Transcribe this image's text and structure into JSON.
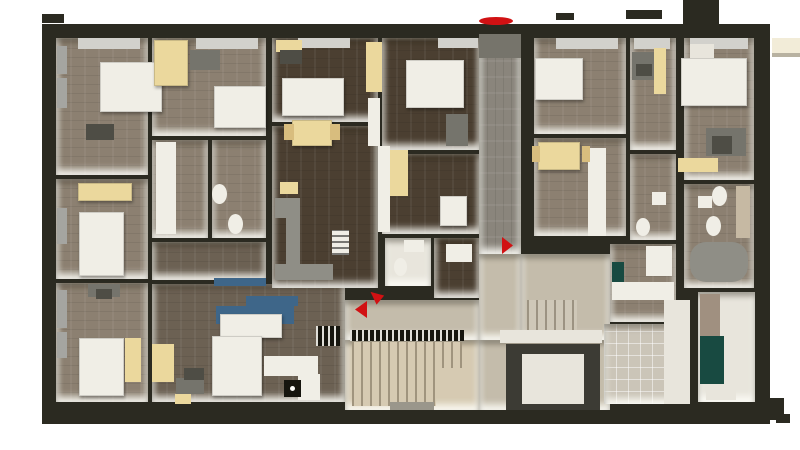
{
  "palette": {
    "wall": "#2b2a21",
    "A": "#8c8071",
    "B": "#4b3f31",
    "LV": "#6c6153",
    "C": "#8a857c",
    "D": "#c4bcab",
    "ST": "#d6cab2",
    "STL": "#cfc8b8",
    "TILE": "#cbc5b8",
    "WHT": "#e8e5dc",
    "GRY": "#76746b",
    "GRY2": "#9a968b",
    "white": "#f0eee6",
    "bright": "#fbfbf8",
    "glass": "#a5a5a1",
    "glassL": "#d2d1cc",
    "yellow": "#ebd89d",
    "yellowD": "#d8bd7e",
    "gray": "#75746c",
    "grayD": "#4e4d45",
    "blue": "#3e6689",
    "teal": "#184a41",
    "black": "#16150e",
    "red": "#d11113",
    "cream": "#f2ecd8",
    "shadow": "#b8b2a1",
    "metal": "#8f8e86",
    "elev": "#3c3b34",
    "woodS": "#a09080",
    "tileD": "#c6b9a3"
  },
  "scene": [
    {
      "n": "building-outline",
      "x": 42,
      "y": 24,
      "w": 728,
      "h": 400,
      "c": "wall"
    },
    {
      "n": "top-wall-stub-a",
      "x": 42,
      "y": 14,
      "w": 22,
      "h": 9,
      "c": "wall"
    },
    {
      "n": "top-wall-stub-b",
      "x": 556,
      "y": 13,
      "w": 18,
      "h": 7,
      "c": "wall"
    },
    {
      "n": "top-wall-stub-c",
      "x": 626,
      "y": 10,
      "w": 36,
      "h": 9,
      "c": "wall"
    },
    {
      "n": "top-wall-block",
      "x": 683,
      "y": 0,
      "w": 36,
      "h": 26,
      "c": "wall"
    },
    {
      "n": "canopy",
      "x": 772,
      "y": 38,
      "w": 28,
      "h": 15,
      "c": "cream"
    },
    {
      "n": "canopy-shadow",
      "x": 772,
      "y": 53,
      "w": 28,
      "h": 4,
      "c": "shadow"
    },
    {
      "n": "bottom-wall-step",
      "x": 756,
      "y": 398,
      "w": 28,
      "h": 22,
      "c": "wall"
    },
    {
      "n": "bottom-wall-foot",
      "x": 776,
      "y": 414,
      "w": 14,
      "h": 9,
      "c": "wall"
    },
    {
      "n": "room-bed-1",
      "x": 56,
      "y": 38,
      "w": 92,
      "h": 137,
      "c": "A",
      "cls": "room planks"
    },
    {
      "n": "room-bed-2",
      "x": 56,
      "y": 179,
      "w": 92,
      "h": 100,
      "c": "A",
      "cls": "room planks"
    },
    {
      "n": "room-bed-3",
      "x": 56,
      "y": 283,
      "w": 92,
      "h": 119,
      "c": "A",
      "cls": "room planks"
    },
    {
      "n": "room-bed-4",
      "x": 152,
      "y": 38,
      "w": 114,
      "h": 98,
      "c": "A",
      "cls": "room planks"
    },
    {
      "n": "room-bath-1",
      "x": 152,
      "y": 140,
      "w": 56,
      "h": 98,
      "c": "A",
      "cls": "room planks"
    },
    {
      "n": "room-bath-2",
      "x": 212,
      "y": 140,
      "w": 54,
      "h": 98,
      "c": "A",
      "cls": "room planks"
    },
    {
      "n": "room-living-strip",
      "x": 152,
      "y": 242,
      "w": 114,
      "h": 38,
      "c": "LV",
      "cls": "room planks"
    },
    {
      "n": "room-living",
      "x": 152,
      "y": 284,
      "w": 193,
      "h": 118,
      "c": "LV",
      "cls": "room planks"
    },
    {
      "n": "room-dark-1",
      "x": 272,
      "y": 38,
      "w": 106,
      "h": 84,
      "c": "B",
      "cls": "room planks"
    },
    {
      "n": "room-dark-2",
      "x": 382,
      "y": 38,
      "w": 98,
      "h": 112,
      "c": "B",
      "cls": "room planks"
    },
    {
      "n": "room-dark-3",
      "x": 272,
      "y": 126,
      "w": 106,
      "h": 162,
      "c": "B",
      "cls": "room planks"
    },
    {
      "n": "room-dark-4",
      "x": 382,
      "y": 154,
      "w": 98,
      "h": 80,
      "c": "B",
      "cls": "room planks"
    },
    {
      "n": "room-bath-mid",
      "x": 385,
      "y": 238,
      "w": 46,
      "h": 48,
      "c": "WHT",
      "cls": "room"
    },
    {
      "n": "room-dark-5",
      "x": 434,
      "y": 238,
      "w": 46,
      "h": 60,
      "c": "B",
      "cls": "room planks"
    },
    {
      "n": "corridor",
      "x": 479,
      "y": 34,
      "w": 42,
      "h": 220,
      "c": "C",
      "cls": "room planksv"
    },
    {
      "n": "entry-pad",
      "x": 479,
      "y": 34,
      "w": 42,
      "h": 24,
      "c": "GRY"
    },
    {
      "n": "hall-mid",
      "x": 479,
      "y": 254,
      "w": 42,
      "h": 86,
      "c": "D",
      "cls": "room"
    },
    {
      "n": "hall-left",
      "x": 345,
      "y": 300,
      "w": 134,
      "h": 40,
      "c": "D",
      "cls": "room"
    },
    {
      "n": "hall-right",
      "x": 521,
      "y": 254,
      "w": 89,
      "h": 86,
      "c": "D",
      "cls": "room"
    },
    {
      "n": "stair-room",
      "x": 345,
      "y": 340,
      "w": 134,
      "h": 70,
      "c": "ST",
      "cls": "room"
    },
    {
      "n": "elevator-hall",
      "x": 479,
      "y": 340,
      "w": 131,
      "h": 70,
      "c": "D",
      "cls": "room"
    },
    {
      "n": "room-bed-5",
      "x": 534,
      "y": 38,
      "w": 92,
      "h": 96,
      "c": "A",
      "cls": "room planks"
    },
    {
      "n": "room-desk",
      "x": 630,
      "y": 38,
      "w": 46,
      "h": 112,
      "c": "A",
      "cls": "room planks"
    },
    {
      "n": "room-living-2",
      "x": 534,
      "y": 138,
      "w": 92,
      "h": 98,
      "c": "A",
      "cls": "room planks"
    },
    {
      "n": "room-bath-3",
      "x": 630,
      "y": 154,
      "w": 46,
      "h": 86,
      "c": "A",
      "cls": "room planks"
    },
    {
      "n": "room-kitchen-2",
      "x": 610,
      "y": 244,
      "w": 66,
      "h": 78,
      "c": "A",
      "cls": "room planks"
    },
    {
      "n": "room-tile",
      "x": 604,
      "y": 324,
      "w": 86,
      "h": 80,
      "c": "TILE",
      "cls": "room grid"
    },
    {
      "n": "room-bed-6",
      "x": 684,
      "y": 38,
      "w": 70,
      "h": 142,
      "c": "A",
      "cls": "room planks"
    },
    {
      "n": "room-bath-4",
      "x": 684,
      "y": 184,
      "w": 70,
      "h": 104,
      "c": "A",
      "cls": "room planks"
    },
    {
      "n": "room-storage",
      "x": 698,
      "y": 292,
      "w": 57,
      "h": 110,
      "c": "WHT",
      "cls": "room"
    },
    {
      "n": "window-1",
      "x": 57,
      "y": 46,
      "w": 10,
      "h": 28,
      "c": "glass"
    },
    {
      "n": "window-2",
      "x": 57,
      "y": 78,
      "w": 10,
      "h": 30,
      "c": "glass"
    },
    {
      "n": "window-3",
      "x": 57,
      "y": 208,
      "w": 10,
      "h": 36,
      "c": "glass"
    },
    {
      "n": "window-4",
      "x": 57,
      "y": 290,
      "w": 10,
      "h": 38,
      "c": "glass"
    },
    {
      "n": "window-5",
      "x": 57,
      "y": 332,
      "w": 10,
      "h": 26,
      "c": "glass"
    },
    {
      "n": "window-sill-1",
      "x": 78,
      "y": 38,
      "w": 62,
      "h": 11,
      "c": "glassL"
    },
    {
      "n": "window-sill-2",
      "x": 196,
      "y": 38,
      "w": 62,
      "h": 11,
      "c": "glassL"
    },
    {
      "n": "window-sill-3",
      "x": 298,
      "y": 38,
      "w": 52,
      "h": 10,
      "c": "glassL"
    },
    {
      "n": "window-sill-4",
      "x": 438,
      "y": 38,
      "w": 40,
      "h": 10,
      "c": "glassL"
    },
    {
      "n": "window-sill-5",
      "x": 556,
      "y": 38,
      "w": 62,
      "h": 11,
      "c": "glassL"
    },
    {
      "n": "window-sill-6",
      "x": 634,
      "y": 38,
      "w": 36,
      "h": 11,
      "c": "glassL"
    },
    {
      "n": "window-sill-7",
      "x": 690,
      "y": 38,
      "w": 58,
      "h": 11,
      "c": "glassL"
    },
    {
      "n": "bed-1",
      "x": 100,
      "y": 62,
      "w": 62,
      "h": 50,
      "c": "white",
      "cls": "furn"
    },
    {
      "n": "desk-1",
      "x": 86,
      "y": 124,
      "w": 28,
      "h": 16,
      "c": "grayD"
    },
    {
      "n": "wardrobe-1",
      "x": 154,
      "y": 40,
      "w": 34,
      "h": 46,
      "c": "yellow",
      "cls": "furn"
    },
    {
      "n": "desk-2",
      "x": 190,
      "y": 50,
      "w": 30,
      "h": 20,
      "c": "gray"
    },
    {
      "n": "bed-2",
      "x": 214,
      "y": 86,
      "w": 52,
      "h": 42,
      "c": "white",
      "cls": "furn"
    },
    {
      "n": "kitchenette-1",
      "x": 78,
      "y": 183,
      "w": 54,
      "h": 18,
      "c": "yellow",
      "cls": "furn"
    },
    {
      "n": "bed-3",
      "x": 79,
      "y": 212,
      "w": 45,
      "h": 64,
      "c": "white",
      "cls": "furn"
    },
    {
      "n": "closet-1",
      "x": 156,
      "y": 142,
      "w": 20,
      "h": 92,
      "c": "white"
    },
    {
      "n": "toilet-1",
      "x": 212,
      "y": 184,
      "w": 15,
      "h": 20,
      "c": "white",
      "shape": "ellipse"
    },
    {
      "n": "toilet-2",
      "x": 228,
      "y": 214,
      "w": 15,
      "h": 20,
      "c": "white",
      "shape": "ellipse"
    },
    {
      "n": "desk-3",
      "x": 88,
      "y": 284,
      "w": 32,
      "h": 13,
      "c": "gray"
    },
    {
      "n": "chair-1",
      "x": 96,
      "y": 289,
      "w": 16,
      "h": 10,
      "c": "grayD"
    },
    {
      "n": "bed-4",
      "x": 79,
      "y": 338,
      "w": 45,
      "h": 58,
      "c": "white",
      "cls": "furn"
    },
    {
      "n": "wardrobe-2",
      "x": 125,
      "y": 338,
      "w": 16,
      "h": 44,
      "c": "yellow"
    },
    {
      "n": "desk-4",
      "x": 276,
      "y": 40,
      "w": 26,
      "h": 12,
      "c": "yellow"
    },
    {
      "n": "chair-2",
      "x": 280,
      "y": 50,
      "w": 22,
      "h": 14,
      "c": "grayD"
    },
    {
      "n": "bed-5",
      "x": 282,
      "y": 78,
      "w": 62,
      "h": 38,
      "c": "white",
      "cls": "furn"
    },
    {
      "n": "cabinet-1",
      "x": 366,
      "y": 42,
      "w": 16,
      "h": 50,
      "c": "yellow"
    },
    {
      "n": "wall-band-1",
      "x": 368,
      "y": 98,
      "w": 12,
      "h": 48,
      "c": "white"
    },
    {
      "n": "bed-6",
      "x": 406,
      "y": 60,
      "w": 58,
      "h": 48,
      "c": "white",
      "cls": "furn"
    },
    {
      "n": "desk-5",
      "x": 446,
      "y": 114,
      "w": 22,
      "h": 32,
      "c": "gray"
    },
    {
      "n": "table-1",
      "x": 292,
      "y": 120,
      "w": 40,
      "h": 26,
      "c": "yellow",
      "cls": "furn"
    },
    {
      "n": "chair-3",
      "x": 284,
      "y": 124,
      "w": 10,
      "h": 16,
      "c": "yellowD"
    },
    {
      "n": "chair-4",
      "x": 330,
      "y": 124,
      "w": 10,
      "h": 16,
      "c": "yellowD"
    },
    {
      "n": "wall-band-2",
      "x": 378,
      "y": 146,
      "w": 12,
      "h": 86,
      "c": "white"
    },
    {
      "n": "wardrobe-3",
      "x": 390,
      "y": 150,
      "w": 18,
      "h": 46,
      "c": "yellow"
    },
    {
      "n": "cabinet-2",
      "x": 280,
      "y": 182,
      "w": 18,
      "h": 12,
      "c": "yellow"
    },
    {
      "n": "counter-1",
      "x": 275,
      "y": 198,
      "w": 25,
      "h": 20,
      "c": "metal"
    },
    {
      "n": "counter-2",
      "x": 286,
      "y": 218,
      "w": 14,
      "h": 58,
      "c": "metal"
    },
    {
      "n": "counter-3",
      "x": 275,
      "y": 264,
      "w": 58,
      "h": 16,
      "c": "metal"
    },
    {
      "n": "radiator-1",
      "x": 332,
      "y": 230,
      "w": 17,
      "h": 25,
      "c": "white",
      "cls": "rad"
    },
    {
      "n": "toilet-3",
      "x": 394,
      "y": 258,
      "w": 13,
      "h": 18,
      "c": "white",
      "shape": "ellipse"
    },
    {
      "n": "sink-1",
      "x": 404,
      "y": 240,
      "w": 20,
      "h": 12,
      "c": "white"
    },
    {
      "n": "bed-7",
      "x": 440,
      "y": 196,
      "w": 27,
      "h": 30,
      "c": "white",
      "cls": "furn"
    },
    {
      "n": "cabinet-3",
      "x": 446,
      "y": 244,
      "w": 26,
      "h": 18,
      "c": "white"
    },
    {
      "n": "tv-bench",
      "x": 214,
      "y": 278,
      "w": 52,
      "h": 8,
      "c": "blue"
    },
    {
      "n": "sofa-1",
      "x": 216,
      "y": 306,
      "w": 78,
      "h": 18,
      "c": "blue"
    },
    {
      "n": "sofa-cushions",
      "x": 246,
      "y": 296,
      "w": 52,
      "h": 10,
      "c": "blue"
    },
    {
      "n": "sofa-table",
      "x": 220,
      "y": 314,
      "w": 62,
      "h": 24,
      "c": "white",
      "cls": "furn"
    },
    {
      "n": "rack-1",
      "x": 316,
      "y": 326,
      "w": 24,
      "h": 20,
      "c": "black",
      "cls": "hatch"
    },
    {
      "n": "bed-8",
      "x": 212,
      "y": 336,
      "w": 50,
      "h": 60,
      "c": "white",
      "cls": "furn"
    },
    {
      "n": "wardrobe-4",
      "x": 152,
      "y": 344,
      "w": 22,
      "h": 38,
      "c": "yellow"
    },
    {
      "n": "desk-6",
      "x": 176,
      "y": 378,
      "w": 28,
      "h": 16,
      "c": "gray"
    },
    {
      "n": "printer-1",
      "x": 184,
      "y": 368,
      "w": 20,
      "h": 12,
      "c": "grayD"
    },
    {
      "n": "box-1",
      "x": 175,
      "y": 394,
      "w": 16,
      "h": 10,
      "c": "yellow"
    },
    {
      "n": "kitchen-counter-1",
      "x": 264,
      "y": 356,
      "w": 54,
      "h": 20,
      "c": "white"
    },
    {
      "n": "kitchen-counter-2",
      "x": 298,
      "y": 374,
      "w": 22,
      "h": 26,
      "c": "white"
    },
    {
      "n": "stove-1",
      "x": 284,
      "y": 380,
      "w": 17,
      "h": 17,
      "c": "black"
    },
    {
      "n": "stove-dot",
      "x": 290,
      "y": 386,
      "w": 5,
      "h": 5,
      "c": "bright",
      "shape": "ellipse"
    },
    {
      "n": "bed-9",
      "x": 535,
      "y": 58,
      "w": 48,
      "h": 42,
      "c": "white",
      "cls": "furn"
    },
    {
      "n": "desk-7",
      "x": 632,
      "y": 52,
      "w": 22,
      "h": 28,
      "c": "gray"
    },
    {
      "n": "chair-5",
      "x": 636,
      "y": 64,
      "w": 16,
      "h": 12,
      "c": "grayD"
    },
    {
      "n": "wardrobe-5",
      "x": 654,
      "y": 48,
      "w": 12,
      "h": 46,
      "c": "yellow"
    },
    {
      "n": "closet-2",
      "x": 588,
      "y": 148,
      "w": 18,
      "h": 88,
      "c": "white"
    },
    {
      "n": "table-2",
      "x": 538,
      "y": 142,
      "w": 42,
      "h": 28,
      "c": "yellow",
      "cls": "furn"
    },
    {
      "n": "chair-6",
      "x": 532,
      "y": 146,
      "w": 8,
      "h": 16,
      "c": "yellowD"
    },
    {
      "n": "chair-7",
      "x": 582,
      "y": 146,
      "w": 8,
      "h": 16,
      "c": "yellowD"
    },
    {
      "n": "toilet-4",
      "x": 636,
      "y": 218,
      "w": 14,
      "h": 18,
      "c": "white",
      "shape": "ellipse"
    },
    {
      "n": "sink-2",
      "x": 652,
      "y": 192,
      "w": 14,
      "h": 13,
      "c": "white"
    },
    {
      "n": "fridge-1",
      "x": 646,
      "y": 246,
      "w": 26,
      "h": 30,
      "c": "white"
    },
    {
      "n": "teal-cabinet-1",
      "x": 612,
      "y": 262,
      "w": 12,
      "h": 20,
      "c": "teal"
    },
    {
      "n": "counter-4",
      "x": 612,
      "y": 282,
      "w": 62,
      "h": 18,
      "c": "white"
    },
    {
      "n": "shoe-bench",
      "x": 527,
      "y": 300,
      "w": 50,
      "h": 36,
      "c": "STL",
      "cls": "treads"
    },
    {
      "n": "wardrobe-6",
      "x": 681,
      "y": 58,
      "w": 66,
      "h": 48,
      "c": "white",
      "cls": "furn"
    },
    {
      "n": "cabinet-4",
      "x": 690,
      "y": 44,
      "w": 24,
      "h": 14,
      "c": "WHT"
    },
    {
      "n": "desk-8",
      "x": 706,
      "y": 128,
      "w": 40,
      "h": 28,
      "c": "gray"
    },
    {
      "n": "chair-9",
      "x": 712,
      "y": 136,
      "w": 20,
      "h": 18,
      "c": "grayD"
    },
    {
      "n": "bench-1",
      "x": 678,
      "y": 158,
      "w": 40,
      "h": 14,
      "c": "yellow"
    },
    {
      "n": "toilet-5",
      "x": 712,
      "y": 186,
      "w": 15,
      "h": 20,
      "c": "white",
      "shape": "ellipse"
    },
    {
      "n": "toilet-6",
      "x": 706,
      "y": 216,
      "w": 15,
      "h": 20,
      "c": "white",
      "shape": "ellipse"
    },
    {
      "n": "sink-3",
      "x": 698,
      "y": 196,
      "w": 14,
      "h": 12,
      "c": "white"
    },
    {
      "n": "shower-1",
      "x": 736,
      "y": 186,
      "w": 14,
      "h": 52,
      "c": "tileD"
    },
    {
      "n": "tub-1",
      "x": 690,
      "y": 242,
      "w": 58,
      "h": 40,
      "c": "metal",
      "rad": 16
    },
    {
      "n": "wood-shelf",
      "x": 700,
      "y": 294,
      "w": 20,
      "h": 42,
      "c": "woodS"
    },
    {
      "n": "teal-cabinet-2",
      "x": 700,
      "y": 336,
      "w": 24,
      "h": 48,
      "c": "teal"
    },
    {
      "n": "mat-2",
      "x": 706,
      "y": 390,
      "w": 30,
      "h": 10,
      "c": "WHT"
    },
    {
      "n": "stair-railing",
      "x": 350,
      "y": 330,
      "w": 114,
      "h": 11,
      "c": "black",
      "cls": "hatch"
    },
    {
      "n": "stair-flight-1",
      "x": 352,
      "y": 342,
      "w": 110,
      "h": 26,
      "c": "ST",
      "cls": "treads"
    },
    {
      "n": "stair-flight-2",
      "x": 352,
      "y": 368,
      "w": 84,
      "h": 38,
      "c": "ST",
      "cls": "treads"
    },
    {
      "n": "stair-mat",
      "x": 390,
      "y": 402,
      "w": 44,
      "h": 8,
      "c": "GRY2"
    },
    {
      "n": "elevator-top",
      "x": 500,
      "y": 330,
      "w": 102,
      "h": 13,
      "c": "WHT"
    },
    {
      "n": "elevator-frame",
      "x": 506,
      "y": 344,
      "w": 94,
      "h": 66,
      "c": "elev"
    },
    {
      "n": "elevator-cab",
      "x": 522,
      "y": 354,
      "w": 62,
      "h": 50,
      "c": "WHT"
    },
    {
      "n": "entry-mat",
      "x": 483,
      "y": 40,
      "w": 34,
      "h": 18,
      "c": "GRY"
    },
    {
      "n": "wall-face-white",
      "x": 664,
      "y": 300,
      "w": 26,
      "h": 104,
      "c": "WHT"
    },
    {
      "n": "entrance-marker",
      "x": 479,
      "y": 17,
      "w": 34,
      "h": 8,
      "c": "red",
      "shape": "ellipse",
      "int": true
    },
    {
      "n": "door-arrow-right",
      "x": 502,
      "y": 237,
      "w": 11,
      "h": 17,
      "c": "red",
      "shape": "tri-right",
      "int": true
    },
    {
      "n": "door-arrow-left",
      "x": 355,
      "y": 301,
      "w": 12,
      "h": 17,
      "c": "red",
      "shape": "tri-left",
      "int": true
    },
    {
      "n": "door-arrow-left-2",
      "x": 369,
      "y": 290,
      "w": 13,
      "h": 12,
      "c": "red",
      "shape": "tri-left",
      "rot": 40,
      "int": true
    }
  ]
}
